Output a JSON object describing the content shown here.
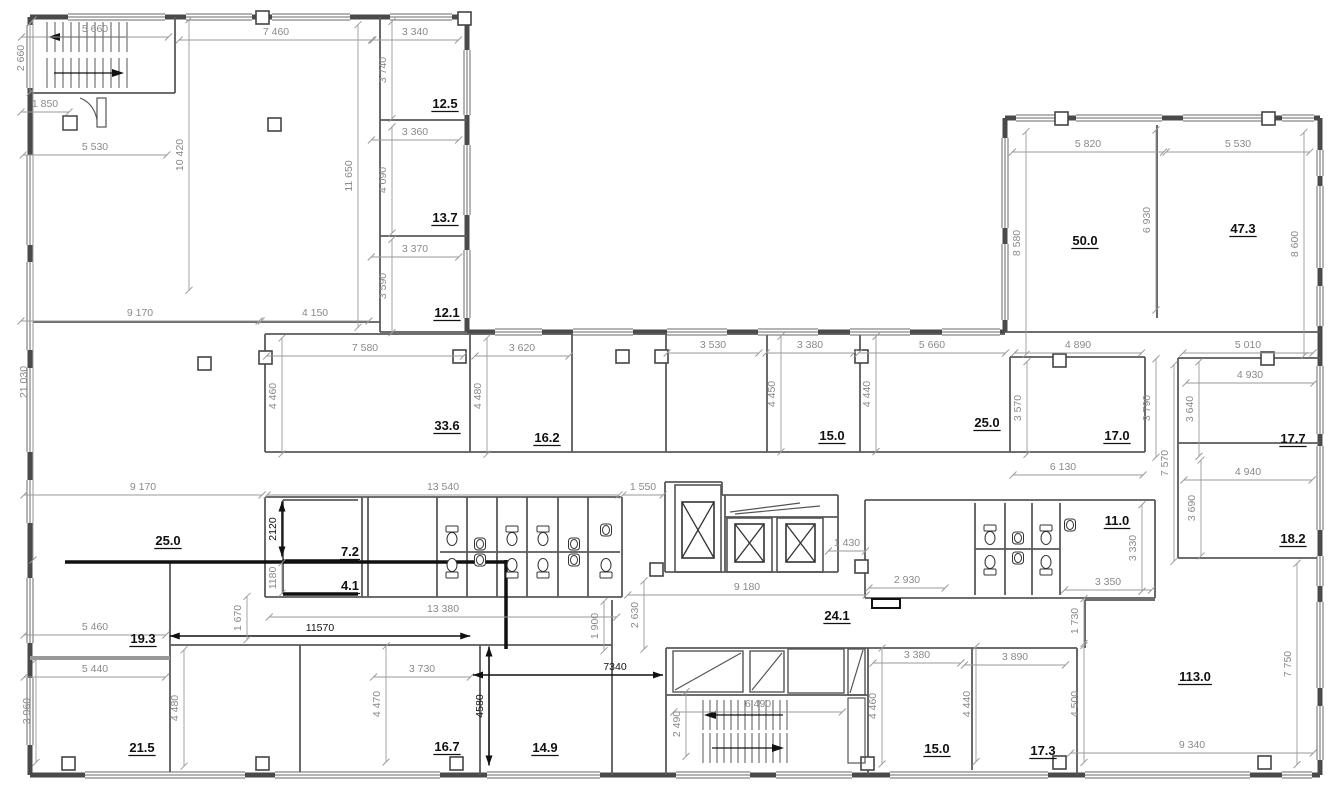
{
  "drawing": {
    "type": "architectural floor plan",
    "units": "mm",
    "wall_color": "#4a4a4a",
    "dim_color": "#8a8a8a",
    "annotation_color": "#111111"
  },
  "labels": {
    "areas": [
      {
        "t": "12.5",
        "x": 445,
        "y": 108
      },
      {
        "t": "13.7",
        "x": 445,
        "y": 222
      },
      {
        "t": "12.1",
        "x": 447,
        "y": 317
      },
      {
        "t": "50.0",
        "x": 1085,
        "y": 245
      },
      {
        "t": "47.3",
        "x": 1243,
        "y": 233
      },
      {
        "t": "33.6",
        "x": 447,
        "y": 430
      },
      {
        "t": "16.2",
        "x": 547,
        "y": 442
      },
      {
        "t": "15.0",
        "x": 832,
        "y": 440
      },
      {
        "t": "25.0",
        "x": 987,
        "y": 427
      },
      {
        "t": "17.0",
        "x": 1117,
        "y": 440
      },
      {
        "t": "17.7",
        "x": 1293,
        "y": 443
      },
      {
        "t": "18.2",
        "x": 1293,
        "y": 543
      },
      {
        "t": "7.2",
        "x": 350,
        "y": 556
      },
      {
        "t": "4.1",
        "x": 350,
        "y": 590
      },
      {
        "t": "11.0",
        "x": 1117,
        "y": 525
      },
      {
        "t": "24.1",
        "x": 837,
        "y": 620
      },
      {
        "t": "25.0",
        "x": 168,
        "y": 545
      },
      {
        "t": "19.3",
        "x": 143,
        "y": 643
      },
      {
        "t": "21.5",
        "x": 142,
        "y": 752
      },
      {
        "t": "16.7",
        "x": 447,
        "y": 751
      },
      {
        "t": "14.9",
        "x": 545,
        "y": 752
      },
      {
        "t": "15.0",
        "x": 937,
        "y": 753
      },
      {
        "t": "17.3",
        "x": 1043,
        "y": 755
      },
      {
        "t": "113.0",
        "x": 1195,
        "y": 681
      }
    ],
    "h_dims": [
      {
        "t": "5 660",
        "x": 95,
        "y": 32
      },
      {
        "t": "7 460",
        "x": 276,
        "y": 35
      },
      {
        "t": "3 340",
        "x": 415,
        "y": 35
      },
      {
        "t": "1 850",
        "x": 45,
        "y": 107
      },
      {
        "t": "5 530",
        "x": 95,
        "y": 150
      },
      {
        "t": "3 360",
        "x": 415,
        "y": 135
      },
      {
        "t": "3 370",
        "x": 415,
        "y": 252
      },
      {
        "t": "5 820",
        "x": 1088,
        "y": 147
      },
      {
        "t": "5 530",
        "x": 1238,
        "y": 147
      },
      {
        "t": "9 170",
        "x": 140,
        "y": 316
      },
      {
        "t": "4 150",
        "x": 315,
        "y": 316
      },
      {
        "t": "7 580",
        "x": 365,
        "y": 351
      },
      {
        "t": "3 620",
        "x": 522,
        "y": 351
      },
      {
        "t": "3 530",
        "x": 713,
        "y": 348
      },
      {
        "t": "3 380",
        "x": 810,
        "y": 348
      },
      {
        "t": "5 660",
        "x": 932,
        "y": 348
      },
      {
        "t": "4 890",
        "x": 1078,
        "y": 348
      },
      {
        "t": "5 010",
        "x": 1248,
        "y": 348
      },
      {
        "t": "4 930",
        "x": 1250,
        "y": 378
      },
      {
        "t": "6 130",
        "x": 1063,
        "y": 470,
        "x1": 1013,
        "x2": 1143
      },
      {
        "t": "4 940",
        "x": 1248,
        "y": 475
      },
      {
        "t": "9 170",
        "x": 143,
        "y": 490
      },
      {
        "t": "13 540",
        "x": 443,
        "y": 490
      },
      {
        "t": "1 550",
        "x": 643,
        "y": 490
      },
      {
        "t": "1 430",
        "x": 847,
        "y": 546
      },
      {
        "t": "2 930",
        "x": 907,
        "y": 583
      },
      {
        "t": "3 350",
        "x": 1108,
        "y": 585
      },
      {
        "t": "9 180",
        "x": 747,
        "y": 590
      },
      {
        "t": "13 380",
        "x": 443,
        "y": 612
      },
      {
        "t": "5 460",
        "x": 95,
        "y": 630
      },
      {
        "t": "11570",
        "x": 320,
        "y": 631,
        "s": "annot"
      },
      {
        "t": "5 440",
        "x": 95,
        "y": 672
      },
      {
        "t": "3 730",
        "x": 422,
        "y": 672
      },
      {
        "t": "7340",
        "x": 615,
        "y": 670,
        "s": "annot",
        "x1": 473,
        "x2": 663
      },
      {
        "t": "3 380",
        "x": 917,
        "y": 658
      },
      {
        "t": "3 890",
        "x": 1015,
        "y": 660
      },
      {
        "t": "6 490",
        "x": 758,
        "y": 707
      },
      {
        "t": "9 340",
        "x": 1192,
        "y": 748
      }
    ],
    "v_dims": [
      {
        "t": "2 660",
        "x": 24,
        "y": 58
      },
      {
        "t": "10 420",
        "x": 183,
        "y": 155
      },
      {
        "t": "11 650",
        "x": 352,
        "y": 176
      },
      {
        "t": "3 740",
        "x": 386,
        "y": 70
      },
      {
        "t": "4 090",
        "x": 386,
        "y": 180
      },
      {
        "t": "3 590",
        "x": 386,
        "y": 286
      },
      {
        "t": "21 030",
        "x": 27,
        "y": 382,
        "y1": 20,
        "y2": 560
      },
      {
        "t": "8 580",
        "x": 1020,
        "y": 243
      },
      {
        "t": "6 930",
        "x": 1150,
        "y": 220
      },
      {
        "t": "8 600",
        "x": 1298,
        "y": 244
      },
      {
        "t": "4 460",
        "x": 276,
        "y": 396
      },
      {
        "t": "4 480",
        "x": 481,
        "y": 396
      },
      {
        "t": "4 450",
        "x": 775,
        "y": 394
      },
      {
        "t": "4 440",
        "x": 870,
        "y": 394
      },
      {
        "t": "3 570",
        "x": 1021,
        "y": 408
      },
      {
        "t": "3 790",
        "x": 1150,
        "y": 408
      },
      {
        "t": "3 640",
        "x": 1193,
        "y": 409
      },
      {
        "t": "7 570",
        "x": 1168,
        "y": 463
      },
      {
        "t": "3 690",
        "x": 1195,
        "y": 508
      },
      {
        "t": "2120",
        "x": 276,
        "y": 529,
        "s": "annot"
      },
      {
        "t": "1180",
        "x": 276,
        "y": 578
      },
      {
        "t": "3 330",
        "x": 1136,
        "y": 548
      },
      {
        "t": "2 630",
        "x": 638,
        "y": 615
      },
      {
        "t": "1 900",
        "x": 598,
        "y": 626
      },
      {
        "t": "1 730",
        "x": 1078,
        "y": 621
      },
      {
        "t": "1 670",
        "x": 241,
        "y": 618
      },
      {
        "t": "3 960",
        "x": 30,
        "y": 711
      },
      {
        "t": "4 480",
        "x": 178,
        "y": 708
      },
      {
        "t": "4 470",
        "x": 380,
        "y": 704
      },
      {
        "t": "4580",
        "x": 483,
        "y": 706,
        "s": "annot"
      },
      {
        "t": "4 460",
        "x": 876,
        "y": 706
      },
      {
        "t": "2 490",
        "x": 680,
        "y": 724
      },
      {
        "t": "4 440",
        "x": 970,
        "y": 704
      },
      {
        "t": "4 500",
        "x": 1078,
        "y": 704
      },
      {
        "t": "7 750",
        "x": 1291,
        "y": 664
      }
    ]
  }
}
